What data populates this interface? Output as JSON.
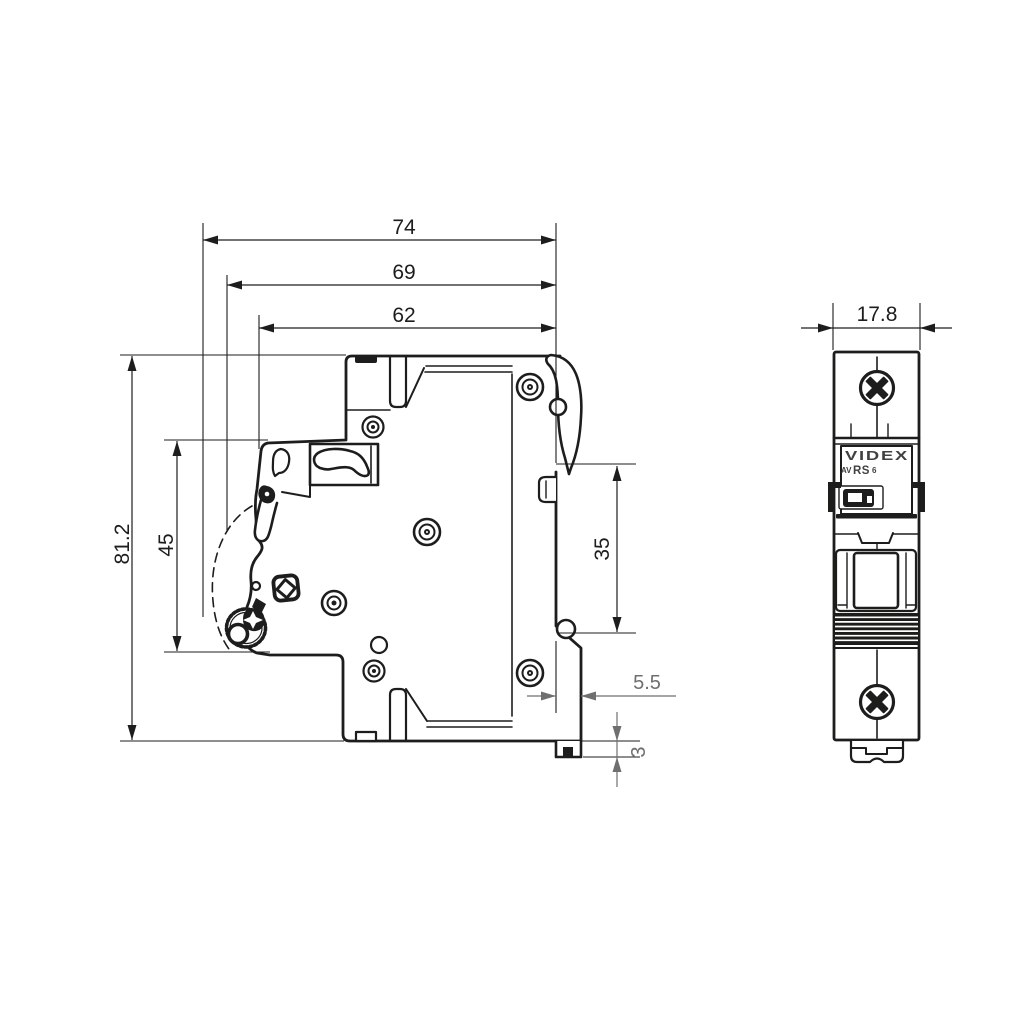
{
  "side_view": {
    "dim_depth_total": "74",
    "dim_depth_body": "69",
    "dim_depth_front": "62",
    "dim_height_total": "81.2",
    "dim_height_front": "45",
    "dim_din_recess": "35",
    "dim_clip_offset": "5.5",
    "dim_clip_tab": "3"
  },
  "front_view": {
    "dim_width": "17.8",
    "brand": "VIDEX",
    "model_prefix": "AV",
    "model_series": "RS",
    "model_rating": "6"
  },
  "colors": {
    "line": "#1d1d1b",
    "dim_secondary": "#6f6f6f",
    "background": "#ffffff"
  }
}
